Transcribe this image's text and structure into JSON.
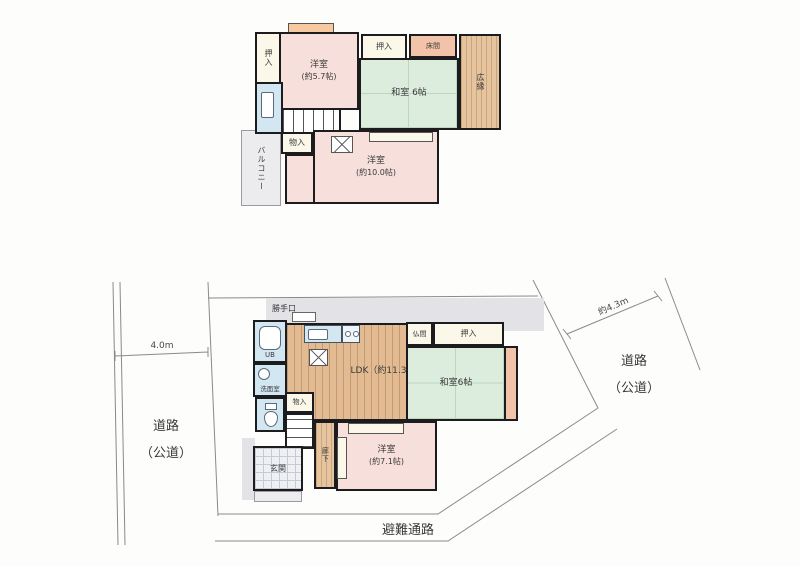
{
  "title": "間取り図（1階・2階・敷地）",
  "colors": {
    "wall": "#1c1c1e",
    "western_room": "#f7dfdb",
    "japanese_room": "#dcedde",
    "wood_floor": "#e2bb92",
    "wet_area": "#d3e7f2",
    "closet": "#fbf8ea",
    "tokonoma": "#f2c3a9",
    "site_gray": "#e3e3e7",
    "boundary_line": "#8a8a8a"
  },
  "f2": {
    "oshiire_left": "押入",
    "yoshitsu57_name": "洋室",
    "yoshitsu57_size": "(約5.7帖)",
    "oshiire_top": "押入",
    "tokonoma": "床間",
    "washitsu": "和室 6帖",
    "hiroen": "広縁",
    "monoire": "物入",
    "balcony": "バルコニー",
    "yoshitsu10_name": "洋室",
    "yoshitsu10_size": "(約10.0帖)"
  },
  "f1": {
    "katteguchi": "勝手口",
    "ub": "UB",
    "senmenshitsu": "洗面室",
    "ldk": "LDK（約11.3帖）",
    "butsuma": "仏間",
    "oshiire": "押入",
    "washitsu": "和室6帖",
    "monoire": "物入",
    "genkan": "玄関",
    "rouka": "廊下",
    "yoshitsu71_name": "洋室",
    "yoshitsu71_size": "(約7.1帖)"
  },
  "site": {
    "road_left_name": "道路",
    "road_left_type": "（公道）",
    "road_left_width": "4.0m",
    "road_right_name": "道路",
    "road_right_type": "（公道）",
    "road_right_width": "約4.3m",
    "evacuation": "避難通路"
  }
}
